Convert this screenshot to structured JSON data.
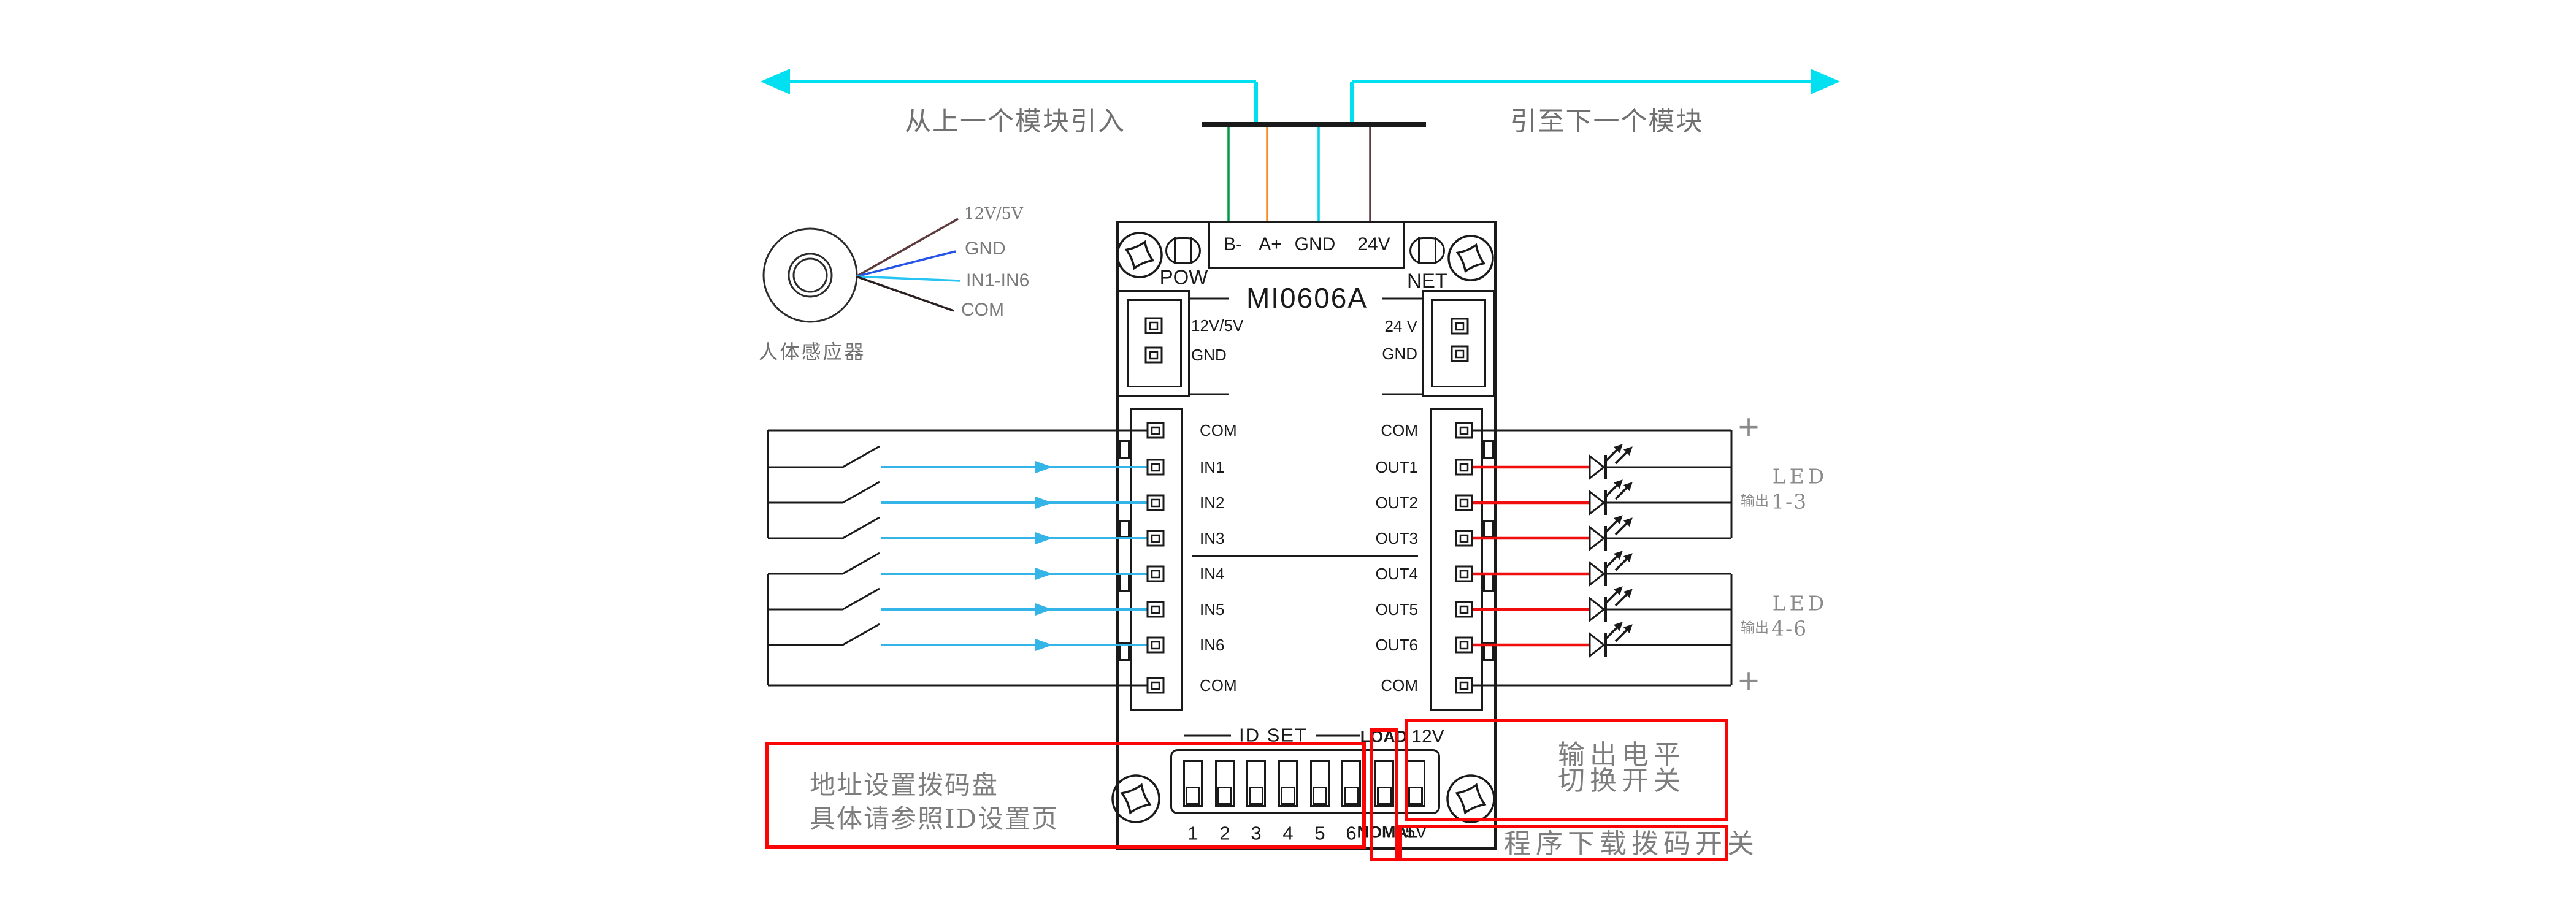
{
  "colors": {
    "arrow_cyan": "#00e0f0",
    "wire_green": "#009a47",
    "wire_orange": "#f68b1f",
    "wire_cyan": "#00d4e6",
    "wire_brown": "#5d3a3e",
    "wire_blue": "#2553e8",
    "wire_skyblue": "#27c3f2",
    "input_cyan": "#35b4e8",
    "wire_red": "#f00d0d",
    "annotation_red": "#f90505",
    "ink": "#1a1a1a",
    "gray": "#7d7d7d",
    "mid_gray": "#8a8a8a",
    "dark_gray": "#707070"
  },
  "top": {
    "left_arrow_label": "从上一个模块引入",
    "right_arrow_label": "引至下一个模块"
  },
  "terminal": {
    "pins": [
      "B-",
      "A+",
      "GND",
      "24V"
    ]
  },
  "module": {
    "title": "MI0606A",
    "pow_label": "POW",
    "net_label": "NET",
    "power_left_labels": [
      "12V/5V",
      "GND"
    ],
    "power_right_labels": [
      "24 V",
      "GND"
    ],
    "input_pin_labels": [
      "COM",
      "IN1",
      "IN2",
      "IN3",
      "IN4",
      "IN5",
      "IN6",
      "COM"
    ],
    "output_pin_labels": [
      "COM",
      "OUT1",
      "OUT2",
      "OUT3",
      "OUT4",
      "OUT5",
      "OUT6",
      "COM"
    ]
  },
  "sensor": {
    "caption": "人体感应器",
    "wire_labels": [
      "12V/5V",
      "GND",
      "IN1-IN6",
      "COM"
    ]
  },
  "led": {
    "plus_symbol": "+",
    "groups": [
      {
        "title": "LED",
        "prefix": "输出",
        "range": "1-3"
      },
      {
        "title": "LED",
        "prefix": "输出",
        "range": "4-6"
      }
    ]
  },
  "dip": {
    "title": "ID SET",
    "numbers": [
      "1",
      "2",
      "3",
      "4",
      "5",
      "6"
    ],
    "load_label": "LOAD",
    "load_voltage": "12V",
    "normal_label": "NOMAL",
    "normal_voltage": "5V"
  },
  "annotations": {
    "address_line1": "地址设置拨码盘",
    "address_line2": "具体请参照ID设置页",
    "level_line1": "输出电平",
    "level_line2": "切换开关",
    "program": "程序下载拨码开关"
  }
}
